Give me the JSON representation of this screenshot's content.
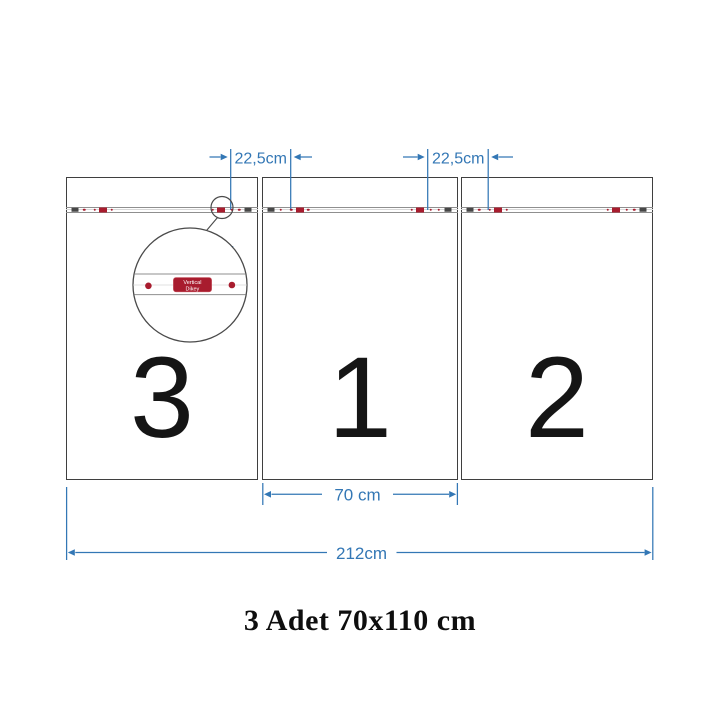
{
  "title": "3 Adet 70x110 cm",
  "panels": [
    {
      "number": "3"
    },
    {
      "number": "1"
    },
    {
      "number": "2"
    }
  ],
  "dimensions": {
    "left_hanger_spacing": "22,5cm",
    "right_hanger_spacing": "22,5cm",
    "panel_width": "70 cm",
    "total_width": "212cm"
  },
  "magnifier": {
    "line1": "Vertical",
    "line2": "Dikey"
  },
  "rail_marks": [
    {
      "pos": 0.047,
      "type": "dark"
    },
    {
      "pos": 0.096,
      "type": "dot"
    },
    {
      "pos": 0.15,
      "type": "dot"
    },
    {
      "pos": 0.192,
      "type": "red"
    },
    {
      "pos": 0.237,
      "type": "dot"
    },
    {
      "pos": 0.764,
      "type": "dot"
    },
    {
      "pos": 0.806,
      "type": "red"
    },
    {
      "pos": 0.862,
      "type": "dot"
    },
    {
      "pos": 0.902,
      "type": "dot"
    },
    {
      "pos": 0.947,
      "type": "dark"
    }
  ],
  "colors": {
    "dimension_blue": "#3377b5",
    "hanger_red": "#a81c2e",
    "bracket_dark": "#474747",
    "panel_border": "#3f3f3f"
  }
}
